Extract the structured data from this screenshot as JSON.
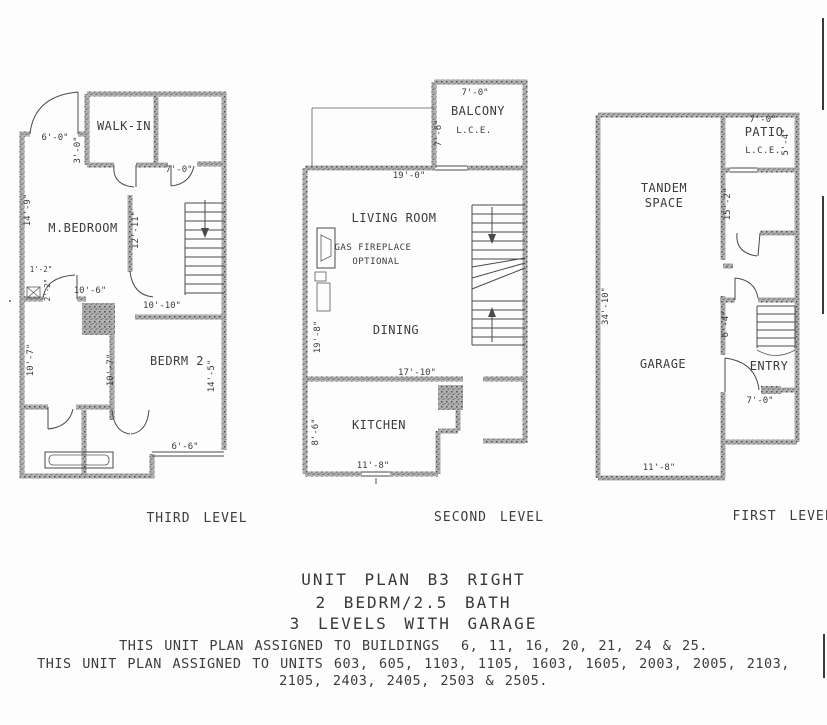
{
  "drawing": {
    "levels": [
      {
        "caption": "THIRD LEVEL",
        "rooms": {
          "walkin": "WALK-IN",
          "mbedroom": "M.BEDROOM",
          "bedrm2": "BEDRM 2"
        },
        "dims": {
          "entry_door": "6'-0\"",
          "closet_side": "3'-0\"",
          "hall_top": "7'-0\"",
          "bedroom_left": "14'-9\"",
          "bedroom_right": "12'-11\"",
          "bedroom_bottom": "10'-6\"",
          "chase_w": "1'-2\"",
          "chase_h": "2'-2\"",
          "hall_bottom": "10'-10\"",
          "bath_left": "10'-7\"",
          "bath_mid": "10'-7\"",
          "bedrm2_right": "14'-5\"",
          "window": "6'-6\""
        }
      },
      {
        "caption": "SECOND LEVEL",
        "rooms": {
          "balcony": "BALCONY",
          "balcony_lce": "L.C.E.",
          "living": "LIVING ROOM",
          "fireplace1": "GAS FIREPLACE",
          "fireplace2": "OPTIONAL",
          "dining": "DINING",
          "kitchen": "KITCHEN"
        },
        "dims": {
          "balcony_top": "7'-0\"",
          "balcony_left": "7'-6\"",
          "living_top": "19'-0\"",
          "left_side": "19'-8\"",
          "dining_bottom": "17'-10\"",
          "kitchen_left": "8'-6\"",
          "kitchen_bottom": "11'-8\""
        }
      },
      {
        "caption": "FIRST LEVEL",
        "rooms": {
          "tandem1": "TANDEM",
          "tandem2": "SPACE",
          "patio": "PATIO",
          "patio_lce": "L.C.E.",
          "garage": "GARAGE",
          "entry": "ENTRY"
        },
        "dims": {
          "patio_top": "7'-0\"",
          "patio_right": "5'-4\"",
          "tandem_right": "15'-2\"",
          "left_side": "34'-10\"",
          "mid_right": "6'-4\"",
          "entry_door": "7'-0\"",
          "garage_bottom": "11'-8\""
        }
      }
    ],
    "footer": {
      "title_line1": "UNIT PLAN B3 RIGHT",
      "title_line2": "2 BEDRM/2.5 BATH",
      "title_line3": "3 LEVELS WITH GARAGE",
      "assigned_line1": "THIS UNIT PLAN ASSIGNED TO BUILDINGS  6, 11, 16, 20, 21, 24 & 25.",
      "assigned_line2": "THIS UNIT PLAN ASSIGNED TO UNITS 603, 605, 1103, 1105, 1603, 1605, 2003, 2005, 2103,",
      "assigned_line3": "2105, 2403, 2405, 2503 & 2505."
    },
    "ink_color": "#3c3c3c",
    "wall_color": "#b0b0b0",
    "paper_color": "#fdfdfd"
  }
}
